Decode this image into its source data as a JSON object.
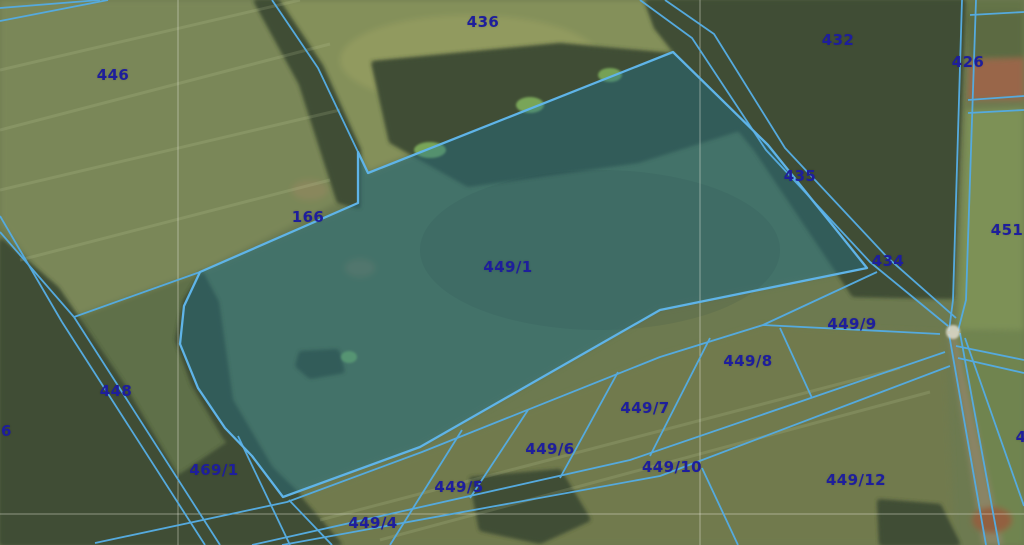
{
  "map": {
    "type": "cadastral-orthophoto-viewer",
    "highlighted_parcel": "449/1",
    "colors": {
      "label": "#1e1e9c",
      "boundary_line": "#55aade",
      "highlight_outline": "#5fb4e8",
      "highlight_fill": "rgba(30,115,145,0.40)",
      "grid_line": "rgba(240,240,228,0.45)"
    },
    "parcel_labels": [
      {
        "text": "446",
        "x": 113,
        "y": 75
      },
      {
        "text": "436",
        "x": 483,
        "y": 22
      },
      {
        "text": "432",
        "x": 838,
        "y": 40
      },
      {
        "text": "426",
        "x": 968,
        "y": 62
      },
      {
        "text": "435",
        "x": 800,
        "y": 176
      },
      {
        "text": "451",
        "x": 1007,
        "y": 230
      },
      {
        "text": "434",
        "x": 888,
        "y": 261
      },
      {
        "text": "166",
        "x": 308,
        "y": 217
      },
      {
        "text": "449/1",
        "x": 508,
        "y": 267
      },
      {
        "text": "448",
        "x": 116,
        "y": 391
      },
      {
        "text": "76",
        "x": 1,
        "y": 431
      },
      {
        "text": "469/1",
        "x": 214,
        "y": 470
      },
      {
        "text": "449/9",
        "x": 852,
        "y": 324
      },
      {
        "text": "449/8",
        "x": 748,
        "y": 361
      },
      {
        "text": "449/7",
        "x": 645,
        "y": 408
      },
      {
        "text": "449/6",
        "x": 550,
        "y": 449
      },
      {
        "text": "449/10",
        "x": 672,
        "y": 467
      },
      {
        "text": "449/5",
        "x": 459,
        "y": 487
      },
      {
        "text": "449/12",
        "x": 856,
        "y": 480
      },
      {
        "text": "449/4",
        "x": 373,
        "y": 523
      },
      {
        "text": "4",
        "x": 1021,
        "y": 437
      }
    ]
  }
}
